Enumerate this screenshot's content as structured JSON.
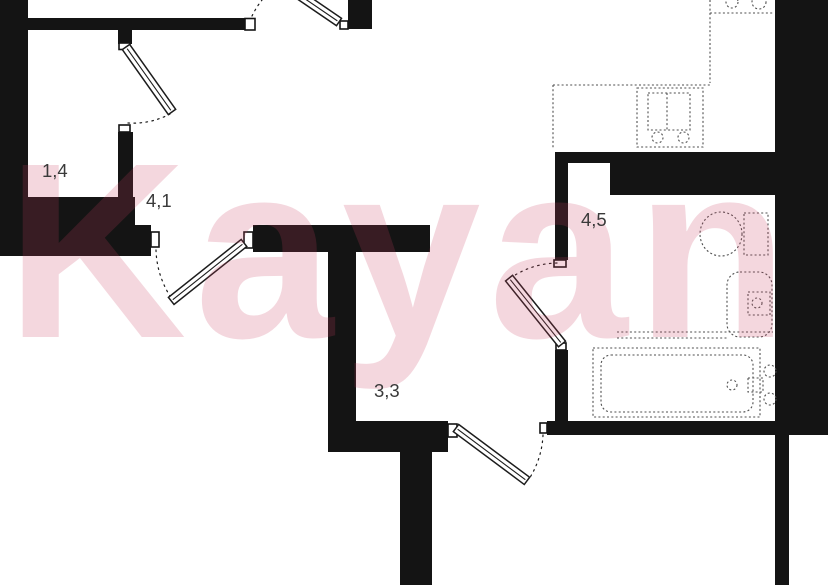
{
  "watermark": {
    "text": "Kayan",
    "color": "#c93e5e",
    "opacity": 0.2
  },
  "labels": {
    "closet": "1,4",
    "hall": "4,1",
    "corridor": "3,3",
    "bathroom": "4,5"
  },
  "colors": {
    "wall": "#141414",
    "ink": "#1c1c1c",
    "fixture": "#4f4f4f",
    "label": "#3a3a3a",
    "background": "#ffffff"
  }
}
